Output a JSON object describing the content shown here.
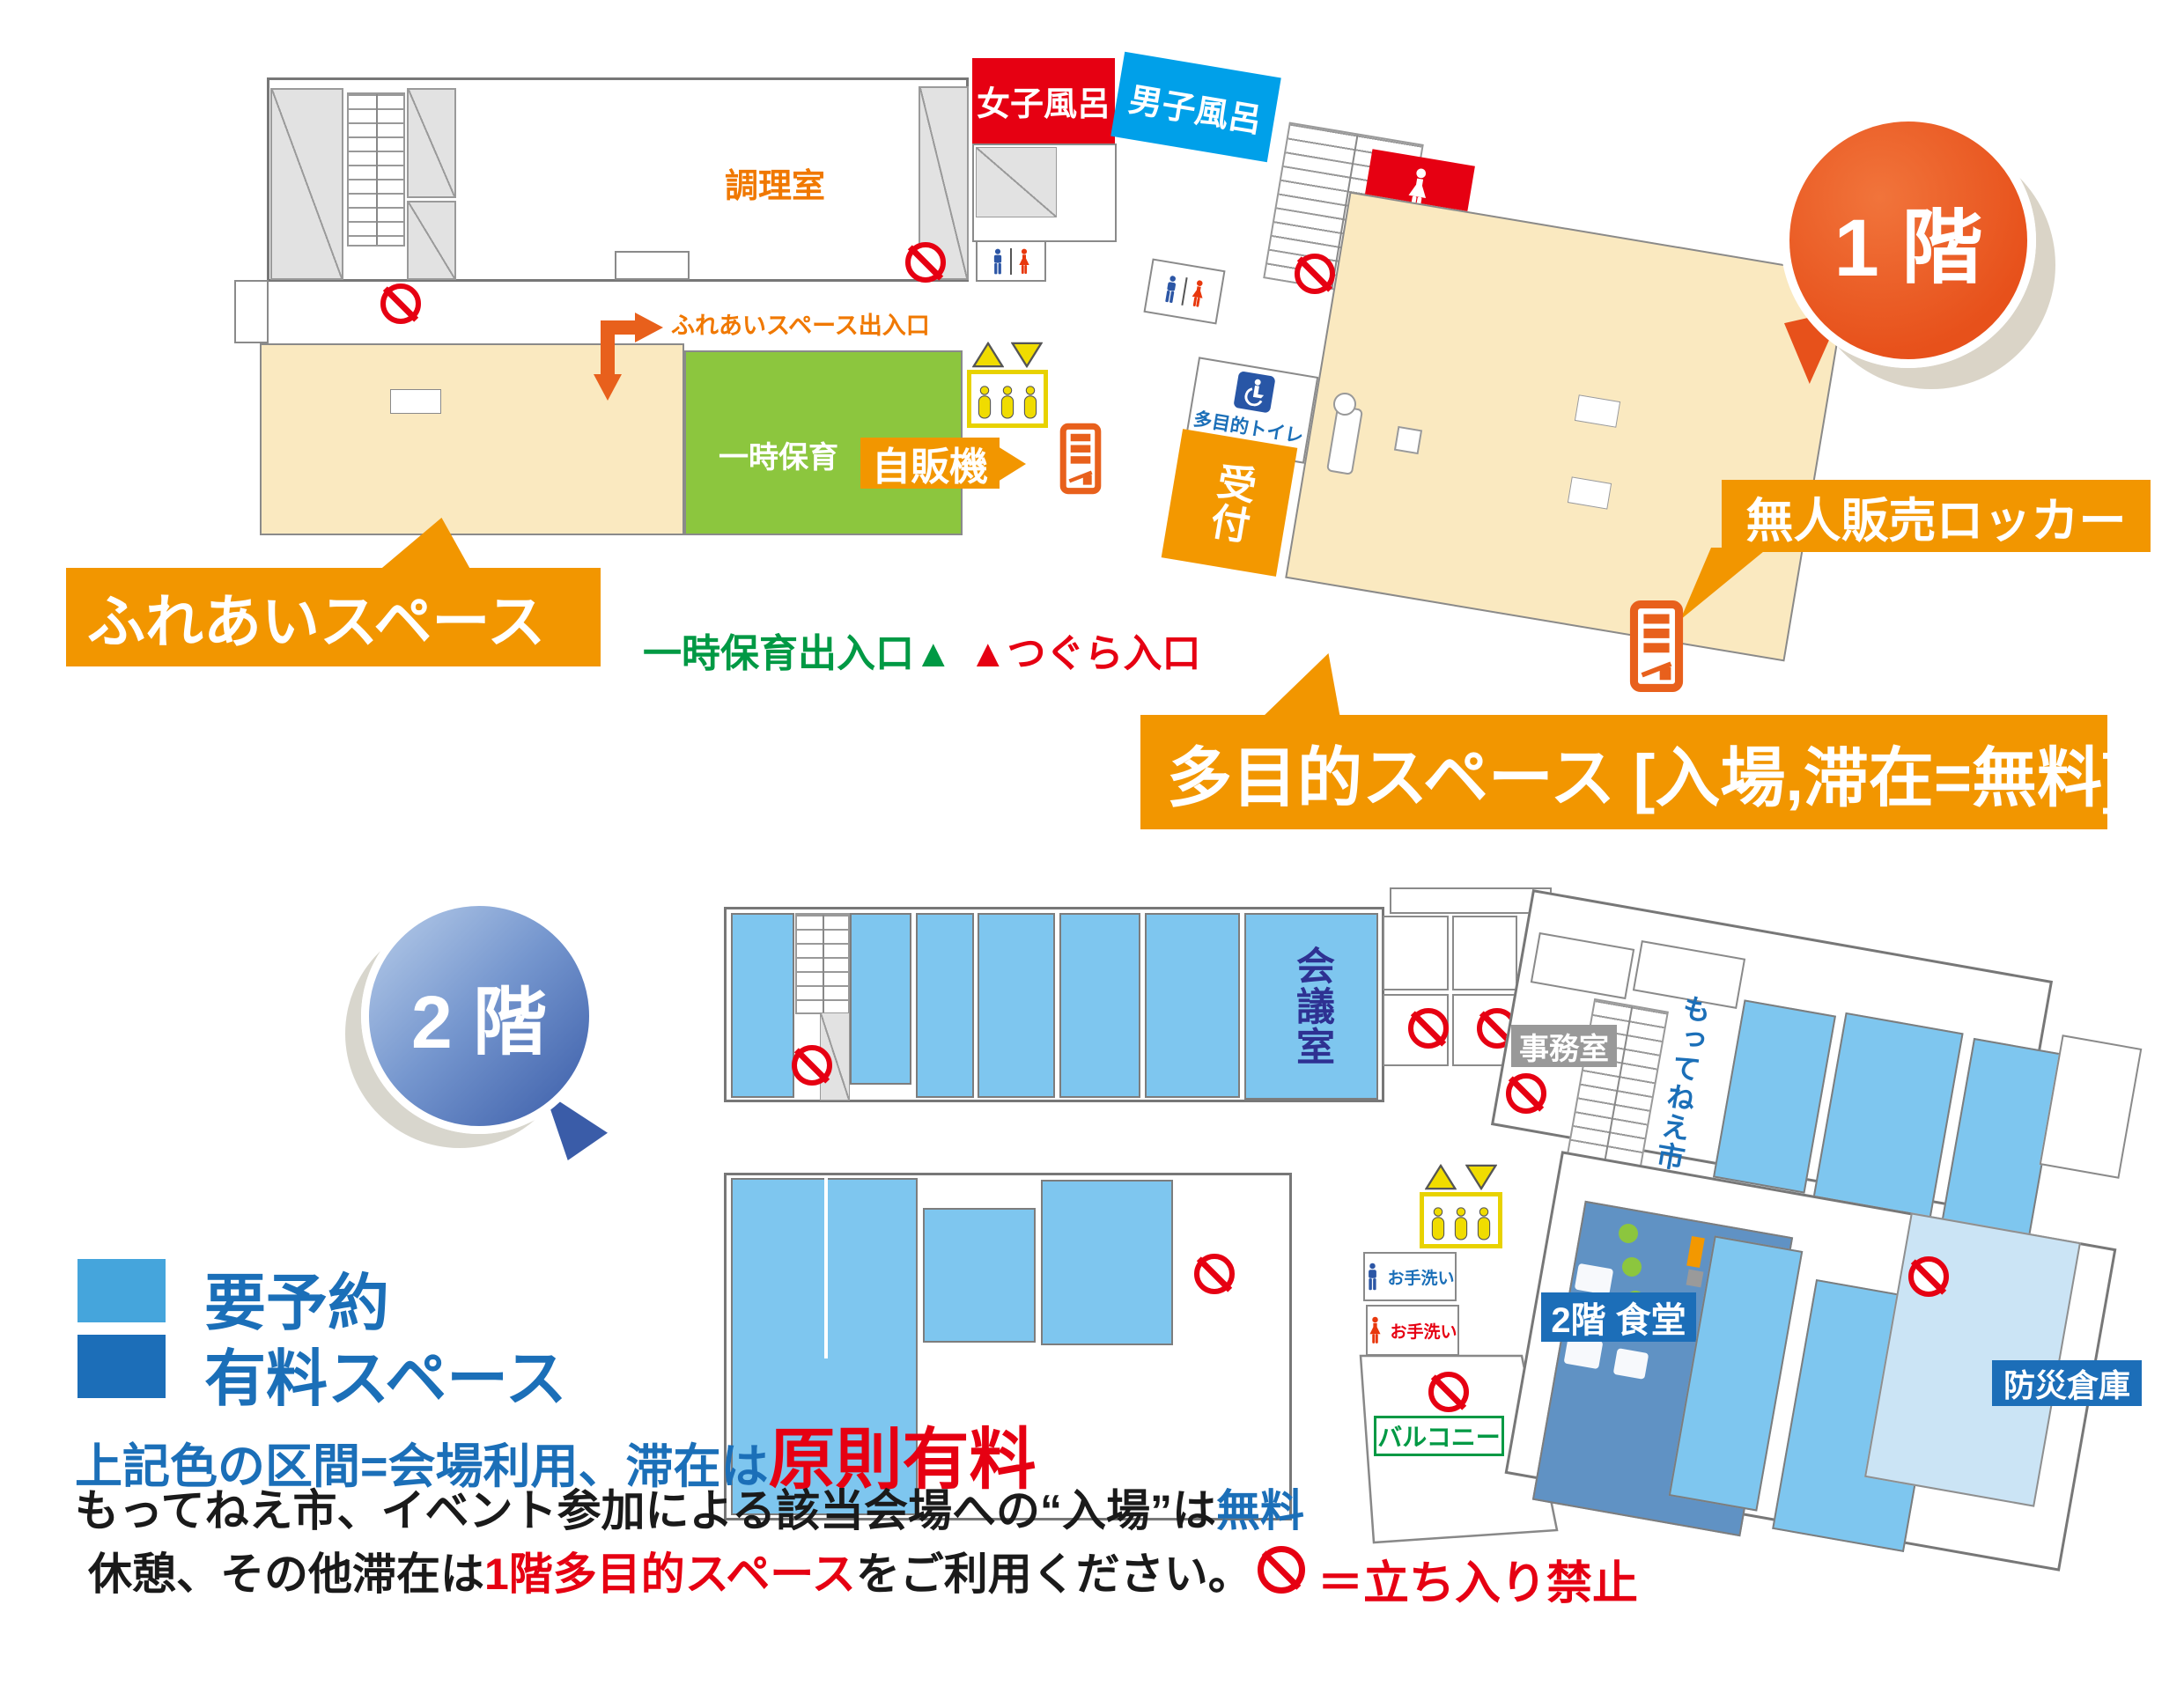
{
  "floor1": {
    "bubble_label": "1 階",
    "kitchen": "調理室",
    "women_bath": "女子風呂",
    "men_bath": "男子風呂",
    "restroom": "お手洗い",
    "accessible_toilet": "多目的トイレ",
    "reception": "受付",
    "childcare": "一時保育",
    "fureai_space": "ふれあいスペース",
    "fureai_entrance": "ふれあいスペース出入口",
    "childcare_entrance": "一時保育出入口▲",
    "tsugura_entrance": "▲つぐら入口",
    "vending": "自販機",
    "locker": "無人販売ロッカー",
    "multipurpose": "多目的スペース [入場,滞在=無料]"
  },
  "floor2": {
    "bubble_label": "2 階",
    "meeting_room": "会議室",
    "office": "事務室",
    "market": "もってねえ市",
    "dining": "2階 食堂",
    "balcony": "バルコニー",
    "disaster_storage": "防災倉庫",
    "restroom": "お手洗い"
  },
  "legend": {
    "reservation": "要予約",
    "paid_space": "有料スペース",
    "note1_blue": "上記色の区間=会場利用、滞在は",
    "note1_red": "原則有料",
    "note2_black": "もってねえ市、イベント参加による該当会場への“入場”は",
    "note2_blue": "無料",
    "note3_black_a": "休憩、その他滞在は",
    "note3_red": "1階多目的スペース",
    "note3_black_b": "をご利用ください。",
    "no_entry": "＝立ち入り禁止"
  },
  "colors": {
    "callout_orange": "#F29600",
    "reception_orange": "#F39800",
    "bubble1_orange": "#E7511B",
    "bubble2_blue": "#3A5CA8",
    "room_light_blue": "#7EC6EF",
    "legend_light_blue": "#45A5DC",
    "legend_dark_blue": "#1C6EB8",
    "dining_blue": "#6092C4",
    "pale_blue": "#CBE4F5",
    "beige": "#FAE9C0",
    "green_room": "#8CC63E",
    "bath_red": "#E60012",
    "bath_blue": "#00A0E9",
    "no_entry_red": "#E60012",
    "green_text": "#009944",
    "orange_text": "#F07800",
    "meeting_text": "#2E3192",
    "elevator_yellow": "#F0DC00"
  }
}
